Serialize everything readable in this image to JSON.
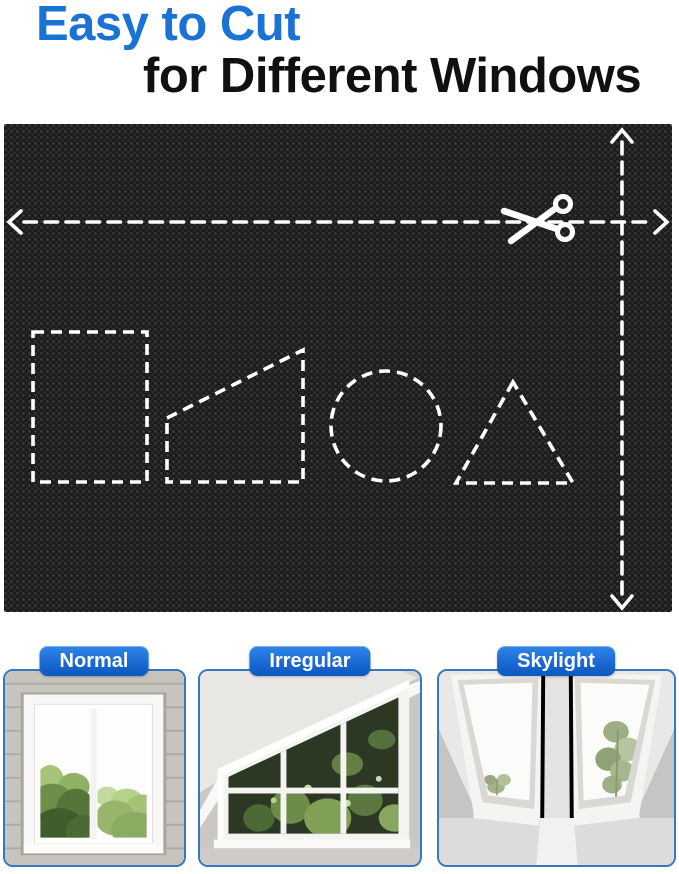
{
  "title": {
    "line1": "Easy to Cut",
    "line2": "for Different Windows"
  },
  "colors": {
    "title_blue": "#1a72d4",
    "title_dark": "#101012",
    "fabric_base": "#1c1c1e",
    "cut_line_white": "#ffffff",
    "pill_blue_top": "#3186e8",
    "pill_blue_bottom": "#0e57bd",
    "card_border_blue": "#3677bd"
  },
  "cut_panel": {
    "scissors_icon": "scissors-icon",
    "width_arrow": "horizontal-cut-line-with-arrows",
    "height_arrow": "vertical-cut-line-with-arrows",
    "cut_shapes": [
      "rectangle",
      "trapezoid",
      "circle",
      "triangle"
    ]
  },
  "window_types": [
    {
      "label": "Normal",
      "photo": "normal-double-casement-window-photo"
    },
    {
      "label": "Irregular",
      "photo": "irregular-slanted-attic-window-photo"
    },
    {
      "label": "Skylight",
      "photo": "skylight-roof-windows-photo"
    }
  ]
}
